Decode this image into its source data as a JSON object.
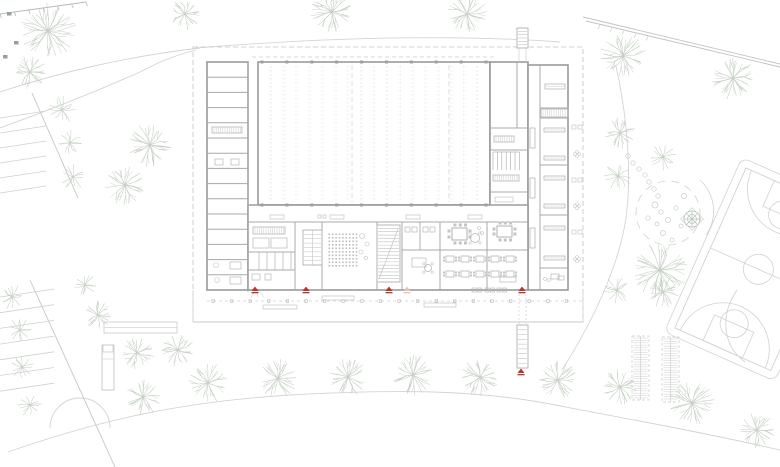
{
  "meta": {
    "drawing_type": "architectural-site-plan-ground-floor",
    "width": 780,
    "height": 467
  },
  "colors": {
    "paper": "#ffffff",
    "wall": "#9a9a9a",
    "wall_light": "#b2b2b2",
    "thin": "#c6c6c6",
    "hair": "#d8d8d8",
    "furn": "#b8b8b8",
    "site": "#d4d4d4",
    "tree": "#c4cfc2",
    "bush": "#93a493",
    "court": "#ccd5ca",
    "red": "#b5342c",
    "red_light": "#e7c0ba"
  },
  "site": {
    "boundary": [
      193,
      47,
      390,
      275
    ],
    "paths": [
      "M 0,92 C 60,72 130,56 200,48",
      "M 0,128 C 50,110 95,92 140,72 C 155,64 172,56 196,50",
      "M 196,48 C 320,38 450,34 560,42",
      "M 616,66 C 627,115 632,175 626,218 C 620,258 600,310 562,370",
      "M 8,452 C 100,420 180,402 290,395 C 400,389 480,390 555,405 C 640,421 715,435 780,450",
      "M 737,290 C 720,315 722,345 745,362",
      "M 50,428 A 30 30 0 0 1 110,428"
    ],
    "diag_lines": [
      [
        32,
        93,
        78,
        198
      ],
      [
        30,
        280,
        115,
        467
      ]
    ],
    "hatch_tl": {
      "x1": 0,
      "y1": 14,
      "x2": 86,
      "y2": 2,
      "ticks": 7
    },
    "diag_tr": [
      [
        583,
        17,
        780,
        64
      ],
      [
        586,
        21,
        780,
        67
      ]
    ],
    "parking_top": {
      "n": 6,
      "x0": 0,
      "y0": 118,
      "dy": 15,
      "len": 46,
      "rise": -7
    },
    "parking_bottom": {
      "n": 7,
      "x0": 0,
      "y0": 297,
      "dy": 15.7,
      "len": 54,
      "rise": -8
    },
    "terrace_rect": [
      104,
      322,
      73,
      11
    ],
    "shelter": [
      102,
      345,
      12,
      45
    ],
    "bike_racks": [
      [
        632,
        336,
        17,
        64
      ],
      [
        662,
        337,
        17,
        65
      ]
    ]
  },
  "trees": [
    [
      48,
      31,
      28
    ],
    [
      185,
      14,
      16
    ],
    [
      30,
      72,
      17
    ],
    [
      62,
      110,
      14
    ],
    [
      70,
      143,
      13
    ],
    [
      73,
      177,
      13
    ],
    [
      150,
      145,
      22
    ],
    [
      125,
      185,
      20
    ],
    [
      332,
      12,
      22
    ],
    [
      467,
      14,
      20
    ],
    [
      623,
      56,
      23
    ],
    [
      733,
      78,
      22
    ],
    [
      620,
      133,
      16
    ],
    [
      663,
      157,
      14
    ],
    [
      618,
      176,
      14
    ],
    [
      660,
      270,
      28
    ],
    [
      617,
      290,
      14
    ],
    [
      663,
      292,
      16
    ],
    [
      255,
      287,
      13
    ],
    [
      12,
      297,
      13
    ],
    [
      20,
      330,
      13
    ],
    [
      22,
      367,
      12
    ],
    [
      30,
      405,
      12
    ],
    [
      85,
      285,
      12
    ],
    [
      98,
      315,
      15
    ],
    [
      137,
      353,
      17
    ],
    [
      178,
      350,
      17
    ],
    [
      208,
      383,
      20
    ],
    [
      143,
      397,
      18
    ],
    [
      278,
      378,
      20
    ],
    [
      348,
      377,
      20
    ],
    [
      413,
      375,
      21
    ],
    [
      480,
      377,
      20
    ],
    [
      558,
      380,
      20
    ],
    [
      620,
      387,
      18
    ],
    [
      692,
      403,
      23
    ],
    [
      757,
      430,
      18
    ]
  ],
  "bushes": [
    [
      7,
      12
    ],
    [
      14,
      41
    ],
    [
      3,
      55
    ]
  ],
  "playground": {
    "ring_center": [
      668,
      213
    ],
    "ring_r": 32,
    "outer_arc": "M 700,180 A 42 42 0 0 1 706,235",
    "web_center": [
      692,
      219
    ],
    "stones": [
      [
        628,
        156
      ],
      [
        633,
        163
      ],
      [
        639,
        169
      ],
      [
        645,
        175
      ],
      [
        649,
        182
      ],
      [
        654,
        189
      ],
      [
        658,
        196
      ]
    ],
    "boulders": [
      [
        655,
        205,
        3
      ],
      [
        661,
        212,
        2.2
      ],
      [
        668,
        220,
        2.6
      ],
      [
        657,
        224,
        2
      ],
      [
        676,
        208,
        2.2
      ],
      [
        681,
        226,
        2
      ],
      [
        663,
        233,
        2.4
      ],
      [
        672,
        240,
        2
      ],
      [
        648,
        218,
        2.2
      ],
      [
        684,
        196,
        2.5
      ]
    ]
  },
  "court": {
    "rotate": [
      24,
      746,
      168
    ],
    "fence": [
      738,
      160,
      121,
      191
    ],
    "rect": [
      746,
      168,
      105,
      175
    ],
    "mid_y": 255.5,
    "center_circle": [
      798.5,
      255.5,
      15
    ],
    "keys": [
      [
        777,
        168,
        43,
        28
      ],
      [
        777,
        315,
        43,
        28
      ]
    ],
    "ft_circles": [
      [
        798.5,
        196,
        14
      ],
      [
        798.5,
        315,
        14
      ]
    ],
    "arcs": [
      "M 752,168 A 46 46 0 0 0 845,168",
      "M 752,343 A 46 46 0 0 1 845,343"
    ]
  },
  "building": {
    "wings": {
      "left": {
        "x": 207,
        "y": 62,
        "w": 41,
        "h": 228,
        "rooms": 15
      },
      "hall": {
        "x": 258,
        "y": 62,
        "w": 232,
        "h": 143,
        "bays": 17,
        "dashed_axes_x": [
          352,
          449
        ],
        "columns": 10,
        "roof_dash_y": 57
      },
      "mid": {
        "x": 490,
        "y": 62,
        "w": 38,
        "h": 153,
        "dividers_y": [
          128,
          150,
          192
        ],
        "top_split_x": 517
      },
      "right": {
        "x": 528,
        "y": 65,
        "w": 40,
        "h": 225,
        "corridor_x": 540,
        "dividers_y": [
          108,
          118,
          165,
          215,
          268
        ]
      },
      "south": {
        "x": 248,
        "y": 205,
        "w": 280,
        "h": 85,
        "corridor_y": 222,
        "walls_x": [
          295,
          322,
          377,
          402,
          440,
          487
        ],
        "south_y": 290
      }
    },
    "stairs": [
      {
        "x": 303,
        "y": 230,
        "w": 19,
        "h": 35,
        "treads": 8,
        "diag": false
      },
      {
        "x": 377,
        "y": 225,
        "w": 23,
        "h": 57,
        "treads": 17,
        "diag": true
      },
      {
        "x": 517,
        "y": 28,
        "w": 11,
        "h": 20,
        "treads": 6,
        "diag": false
      },
      {
        "x": 517,
        "y": 325,
        "w": 11,
        "h": 43,
        "treads": 9,
        "diag": false
      }
    ],
    "seat_grid": {
      "x": 328.5,
      "y": 233.5,
      "cols": 9,
      "rows": 10,
      "dx": 3.4,
      "dy": 3.5,
      "s": 1.6
    },
    "dining": {
      "cols_x": [
        446,
        461,
        476,
        491,
        506
      ],
      "rows_y": [
        256,
        271
      ],
      "w": 8,
      "h": 6
    },
    "furniture": {
      "hatch_v": [
        [
          212,
          127,
          30,
          6
        ],
        [
          494,
          136,
          20,
          6
        ],
        [
          493,
          175,
          26,
          6
        ],
        [
          541,
          109,
          27,
          8
        ],
        [
          253,
          227,
          32,
          7
        ]
      ],
      "benches": [
        [
          495,
          197,
          18,
          5
        ],
        [
          270,
          215,
          14,
          4
        ],
        [
          330,
          215,
          14,
          4
        ],
        [
          406,
          215,
          14,
          4
        ],
        [
          468,
          215,
          14,
          4
        ],
        [
          318,
          215,
          3,
          3
        ],
        [
          323,
          215,
          3,
          3
        ]
      ],
      "tables_long": [
        [
          545,
          84,
          20,
          5
        ],
        [
          544,
          128,
          21,
          4
        ],
        [
          544,
          156,
          21,
          4
        ],
        [
          544,
          176,
          21,
          4
        ],
        [
          544,
          204,
          21,
          4
        ],
        [
          544,
          226,
          21,
          4
        ],
        [
          544,
          256,
          21,
          4
        ]
      ],
      "piers": [
        [
          530,
          128,
          5,
          20
        ],
        [
          530,
          178,
          5,
          20
        ],
        [
          530,
          228,
          5,
          20
        ]
      ],
      "meeting_table": [
        497,
        226,
        15,
        11
      ],
      "lounge_table": [
        452,
        228,
        15,
        12
      ],
      "round_tables": [
        [
          475,
          238,
          4.5
        ],
        [
          428,
          268,
          3.5
        ]
      ],
      "small_rects": [
        [
          405,
          227,
          5,
          5
        ],
        [
          412,
          227,
          5,
          5
        ],
        [
          423,
          227,
          5,
          5
        ],
        [
          430,
          227,
          5,
          5
        ],
        [
          412,
          258,
          14,
          9
        ],
        [
          253,
          238,
          16,
          10
        ],
        [
          271,
          238,
          16,
          10
        ],
        [
          252,
          274,
          8,
          6
        ],
        [
          265,
          274,
          6,
          6
        ],
        [
          551,
          274,
          8,
          5
        ],
        [
          500,
          277,
          16,
          5
        ],
        [
          558,
          276,
          6,
          4
        ],
        [
          215,
          159,
          8,
          6
        ],
        [
          231,
          159,
          8,
          6
        ],
        [
          230,
          262,
          11,
          7
        ],
        [
          230,
          277,
          11,
          7
        ]
      ],
      "stall_lines": {
        "x0": 493,
        "dx": 4.4,
        "n": 7,
        "y1": 152,
        "y2": 170
      },
      "wc_lines": {
        "x0": 259,
        "dx": 8,
        "n": 5,
        "y1": 252,
        "y2": 270
      },
      "misc_circles": [
        [
          216,
          265,
          2.5
        ],
        [
          217,
          280,
          2.5
        ],
        [
          362,
          236,
          2.5
        ],
        [
          367,
          244,
          2
        ],
        [
          361,
          252,
          2
        ],
        [
          366,
          258,
          1.6
        ],
        [
          479,
          228,
          1.5
        ],
        [
          482,
          233,
          1.5
        ],
        [
          545,
          279,
          1.5
        ],
        [
          549,
          280,
          1.5
        ]
      ]
    }
  },
  "plinth": {
    "x1": 193,
    "x2": 583,
    "bottom_y": 322,
    "dash_y": 301,
    "col_start": 213,
    "col_step": 18.6,
    "col_n": 20,
    "benches": [
      [
        263,
        305,
        34,
        4
      ],
      [
        322,
        296,
        32,
        4
      ],
      [
        424,
        303,
        32,
        4
      ]
    ],
    "out_tables": [
      [
        472,
        288
      ],
      [
        485,
        288
      ],
      [
        497,
        288
      ]
    ]
  },
  "east_glyphs": {
    "x": 572,
    "squares_y": [
      125,
      178,
      230
    ],
    "flowers_y": [
      152,
      204,
      257
    ]
  },
  "markers": {
    "dark": [
      [
        255,
        291
      ],
      [
        306,
        291
      ],
      [
        389,
        291
      ],
      [
        522,
        291
      ],
      [
        521,
        373
      ]
    ],
    "light": [
      [
        407,
        291
      ]
    ]
  }
}
